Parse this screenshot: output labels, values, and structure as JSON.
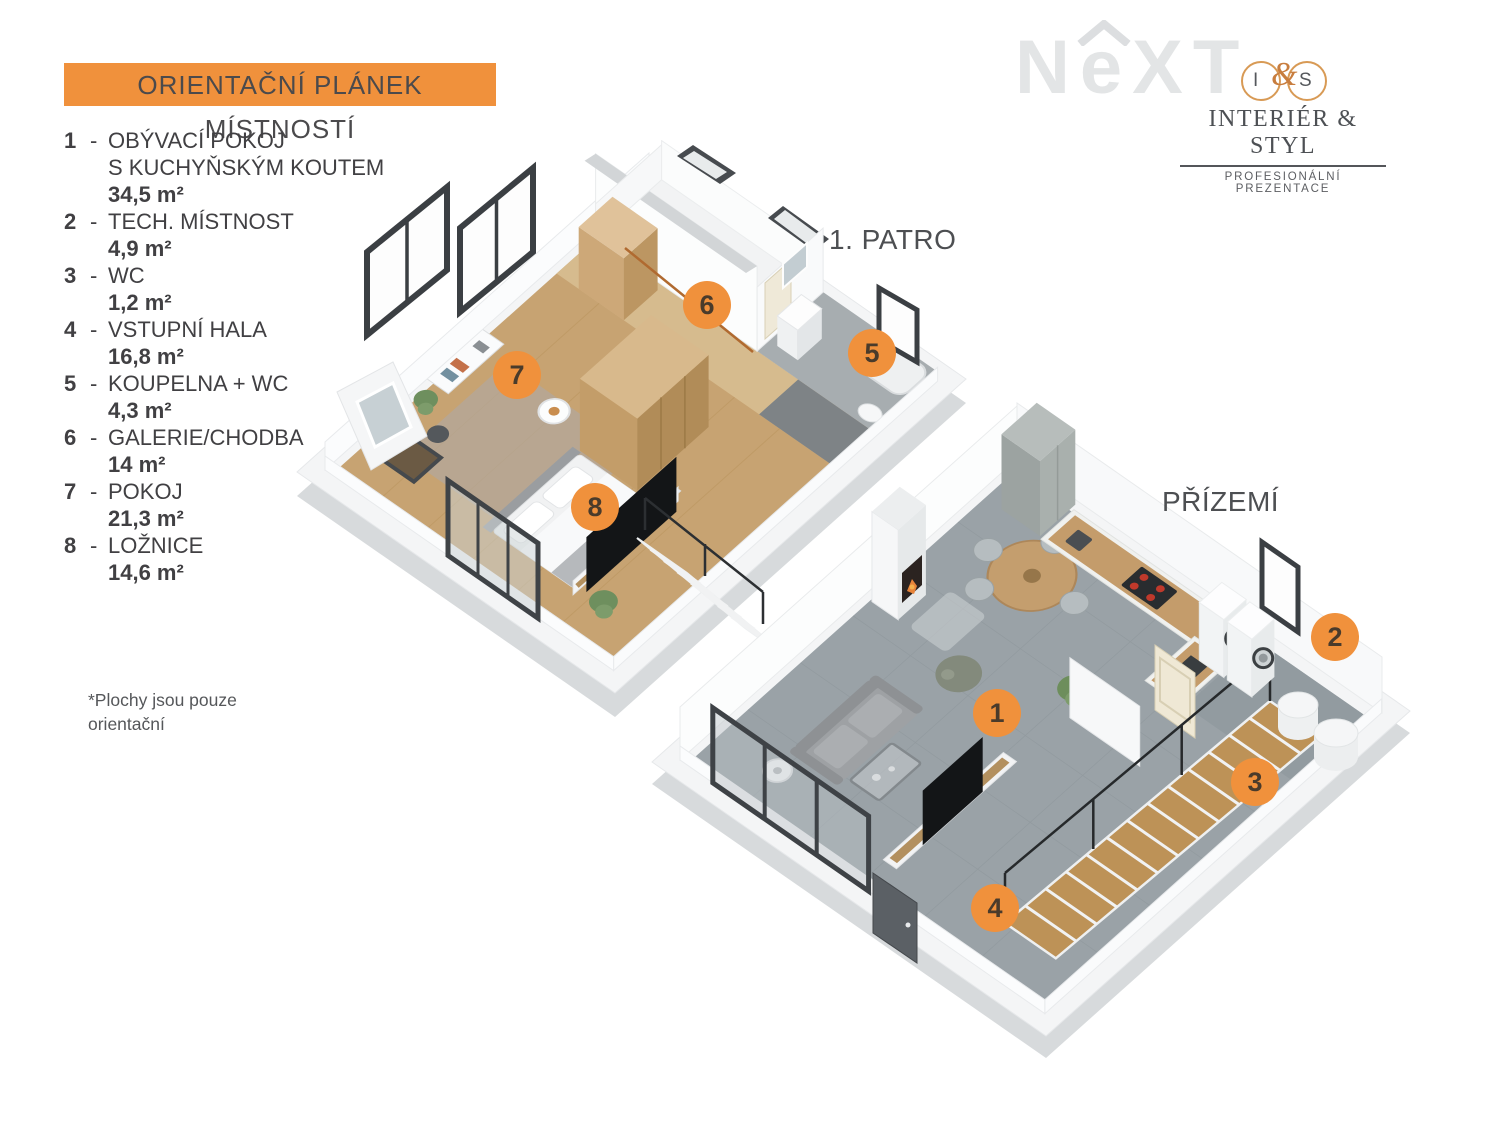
{
  "title_banner": {
    "text": "ORIENTAČNÍ PLÁNEK MÍSTNOSTÍ"
  },
  "legend": {
    "items": [
      {
        "num": "1",
        "name": "OBÝVACÍ POKOJ\nS KUCHYŇSKÝM KOUTEM",
        "area": "34,5 m²"
      },
      {
        "num": "2",
        "name": "TECH. MÍSTNOST",
        "area": "4,9 m²"
      },
      {
        "num": "3",
        "name": "WC",
        "area": "1,2 m²"
      },
      {
        "num": "4",
        "name": "VSTUPNÍ HALA",
        "area": "16,8 m²"
      },
      {
        "num": "5",
        "name": "KOUPELNA + WC",
        "area": "4,3 m²"
      },
      {
        "num": "6",
        "name": "GALERIE/CHODBA",
        "area": "14 m²"
      },
      {
        "num": "7",
        "name": "POKOJ",
        "area": "21,3 m²"
      },
      {
        "num": "8",
        "name": "LOŽNICE",
        "area": "14,6 m²"
      }
    ],
    "footnote": "*Plochy jsou pouze\n orientační"
  },
  "watermark": {
    "n": "N",
    "e": "e",
    "xt": "XT"
  },
  "logo": {
    "monogram_i": "I",
    "monogram_amp": "&",
    "monogram_s": "S",
    "name": "INTERIÉR & STYL",
    "tagline": "PROFESIONÁLNÍ PREZENTACE"
  },
  "floors": {
    "first_floor": {
      "label": "1. PATRO"
    },
    "ground_floor": {
      "label": "PŘÍZEMÍ"
    }
  },
  "markers": [
    {
      "label": "1",
      "x": 997,
      "y": 713
    },
    {
      "label": "2",
      "x": 1335,
      "y": 637
    },
    {
      "label": "3",
      "x": 1255,
      "y": 782
    },
    {
      "label": "4",
      "x": 995,
      "y": 908
    },
    {
      "label": "5",
      "x": 872,
      "y": 353
    },
    {
      "label": "6",
      "x": 707,
      "y": 305
    },
    {
      "label": "7",
      "x": 517,
      "y": 375
    },
    {
      "label": "8",
      "x": 595,
      "y": 507
    }
  ],
  "colors": {
    "accent_orange": "#f0913c",
    "legend_text": "#414043",
    "label_text": "#4d4f52",
    "watermark_gray": "#e3e5e6",
    "logo_orange": "#d89a55"
  }
}
